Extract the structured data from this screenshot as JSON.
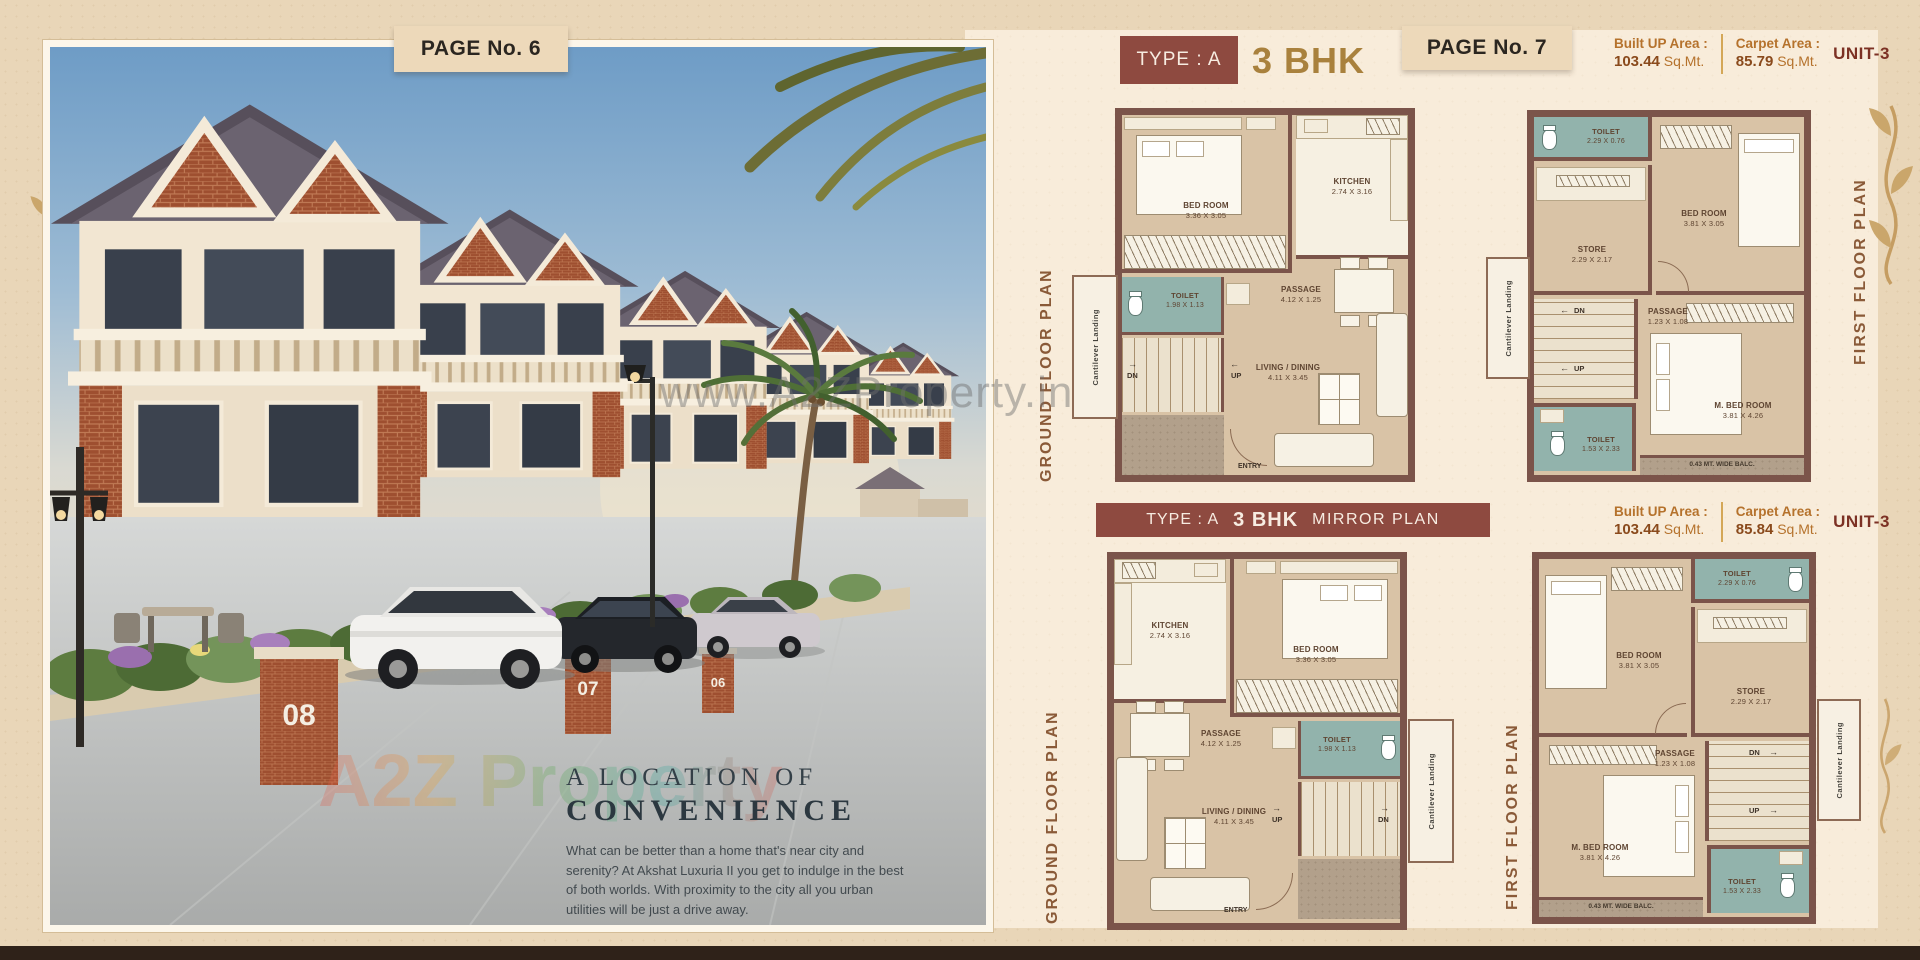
{
  "page_left": {
    "tag": "PAGE No. 6",
    "house_numbers": [
      "08",
      "07",
      "06"
    ],
    "caption": {
      "title_line1": "A LOCATION OF",
      "title_line2": "CONVENIENCE",
      "body": "What can be better than a home that's near city and serenity? At Akshat Luxuria II you get to indulge in the best of both worlds. With proximity to the city all you urban utilities will be just a drive away."
    }
  },
  "page_right": {
    "tag": "PAGE No. 7",
    "header": {
      "type_label": "TYPE : A",
      "bhk": "3 BHK"
    },
    "mirror_header": {
      "type_label": "TYPE : A",
      "bhk": "3 BHK",
      "suffix": "MIRROR PLAN"
    },
    "unit_top": {
      "built_label": "Built UP Area :",
      "built_value": "103.44",
      "built_unit": "Sq.Mt.",
      "carpet_label": "Carpet Area :",
      "carpet_value": "85.79",
      "carpet_unit": "Sq.Mt.",
      "unit": "UNIT-3"
    },
    "unit_bottom": {
      "built_label": "Built UP Area :",
      "built_value": "103.44",
      "built_unit": "Sq.Mt.",
      "carpet_label": "Carpet Area :",
      "carpet_value": "85.84",
      "carpet_unit": "Sq.Mt.",
      "unit": "UNIT-3"
    },
    "plans": {
      "gf": {
        "title": "GROUND FLOOR PLAN",
        "cantilever": "Cantilever Landing",
        "bedroom": "BED ROOM",
        "bedroom_dim": "3.36 X 3.05",
        "kitchen": "KITCHEN",
        "kitchen_dim": "2.74 X 3.16",
        "toilet": "TOILET",
        "toilet_dim": "1.98 X 1.13",
        "passage": "PASSAGE",
        "passage_dim": "4.12 X 1.25",
        "living": "LIVING / DINING",
        "living_dim": "4.11 X 3.45",
        "up": "UP",
        "dn": "DN",
        "entry": "ENTRY"
      },
      "ff": {
        "title": "FIRST FLOOR PLAN",
        "cantilever": "Cantilever Landing",
        "toilet_top": "TOILET",
        "toilet_top_dim": "2.29 X 0.76",
        "bedroom": "BED ROOM",
        "bedroom_dim": "3.81 X 3.05",
        "store": "STORE",
        "store_dim": "2.29 X 2.17",
        "passage": "PASSAGE",
        "passage_dim": "1.23 X 1.08",
        "master": "M. BED ROOM",
        "master_dim": "3.81 X 4.26",
        "toilet_bottom": "TOILET",
        "toilet_bottom_dim": "1.53 X 2.33",
        "balcony": "0.43 MT. WIDE BALC.",
        "up": "UP",
        "dn": "DN"
      }
    }
  },
  "watermarks": {
    "center": "www.A2ZProperty.in",
    "photo": "A2Z Property"
  }
}
